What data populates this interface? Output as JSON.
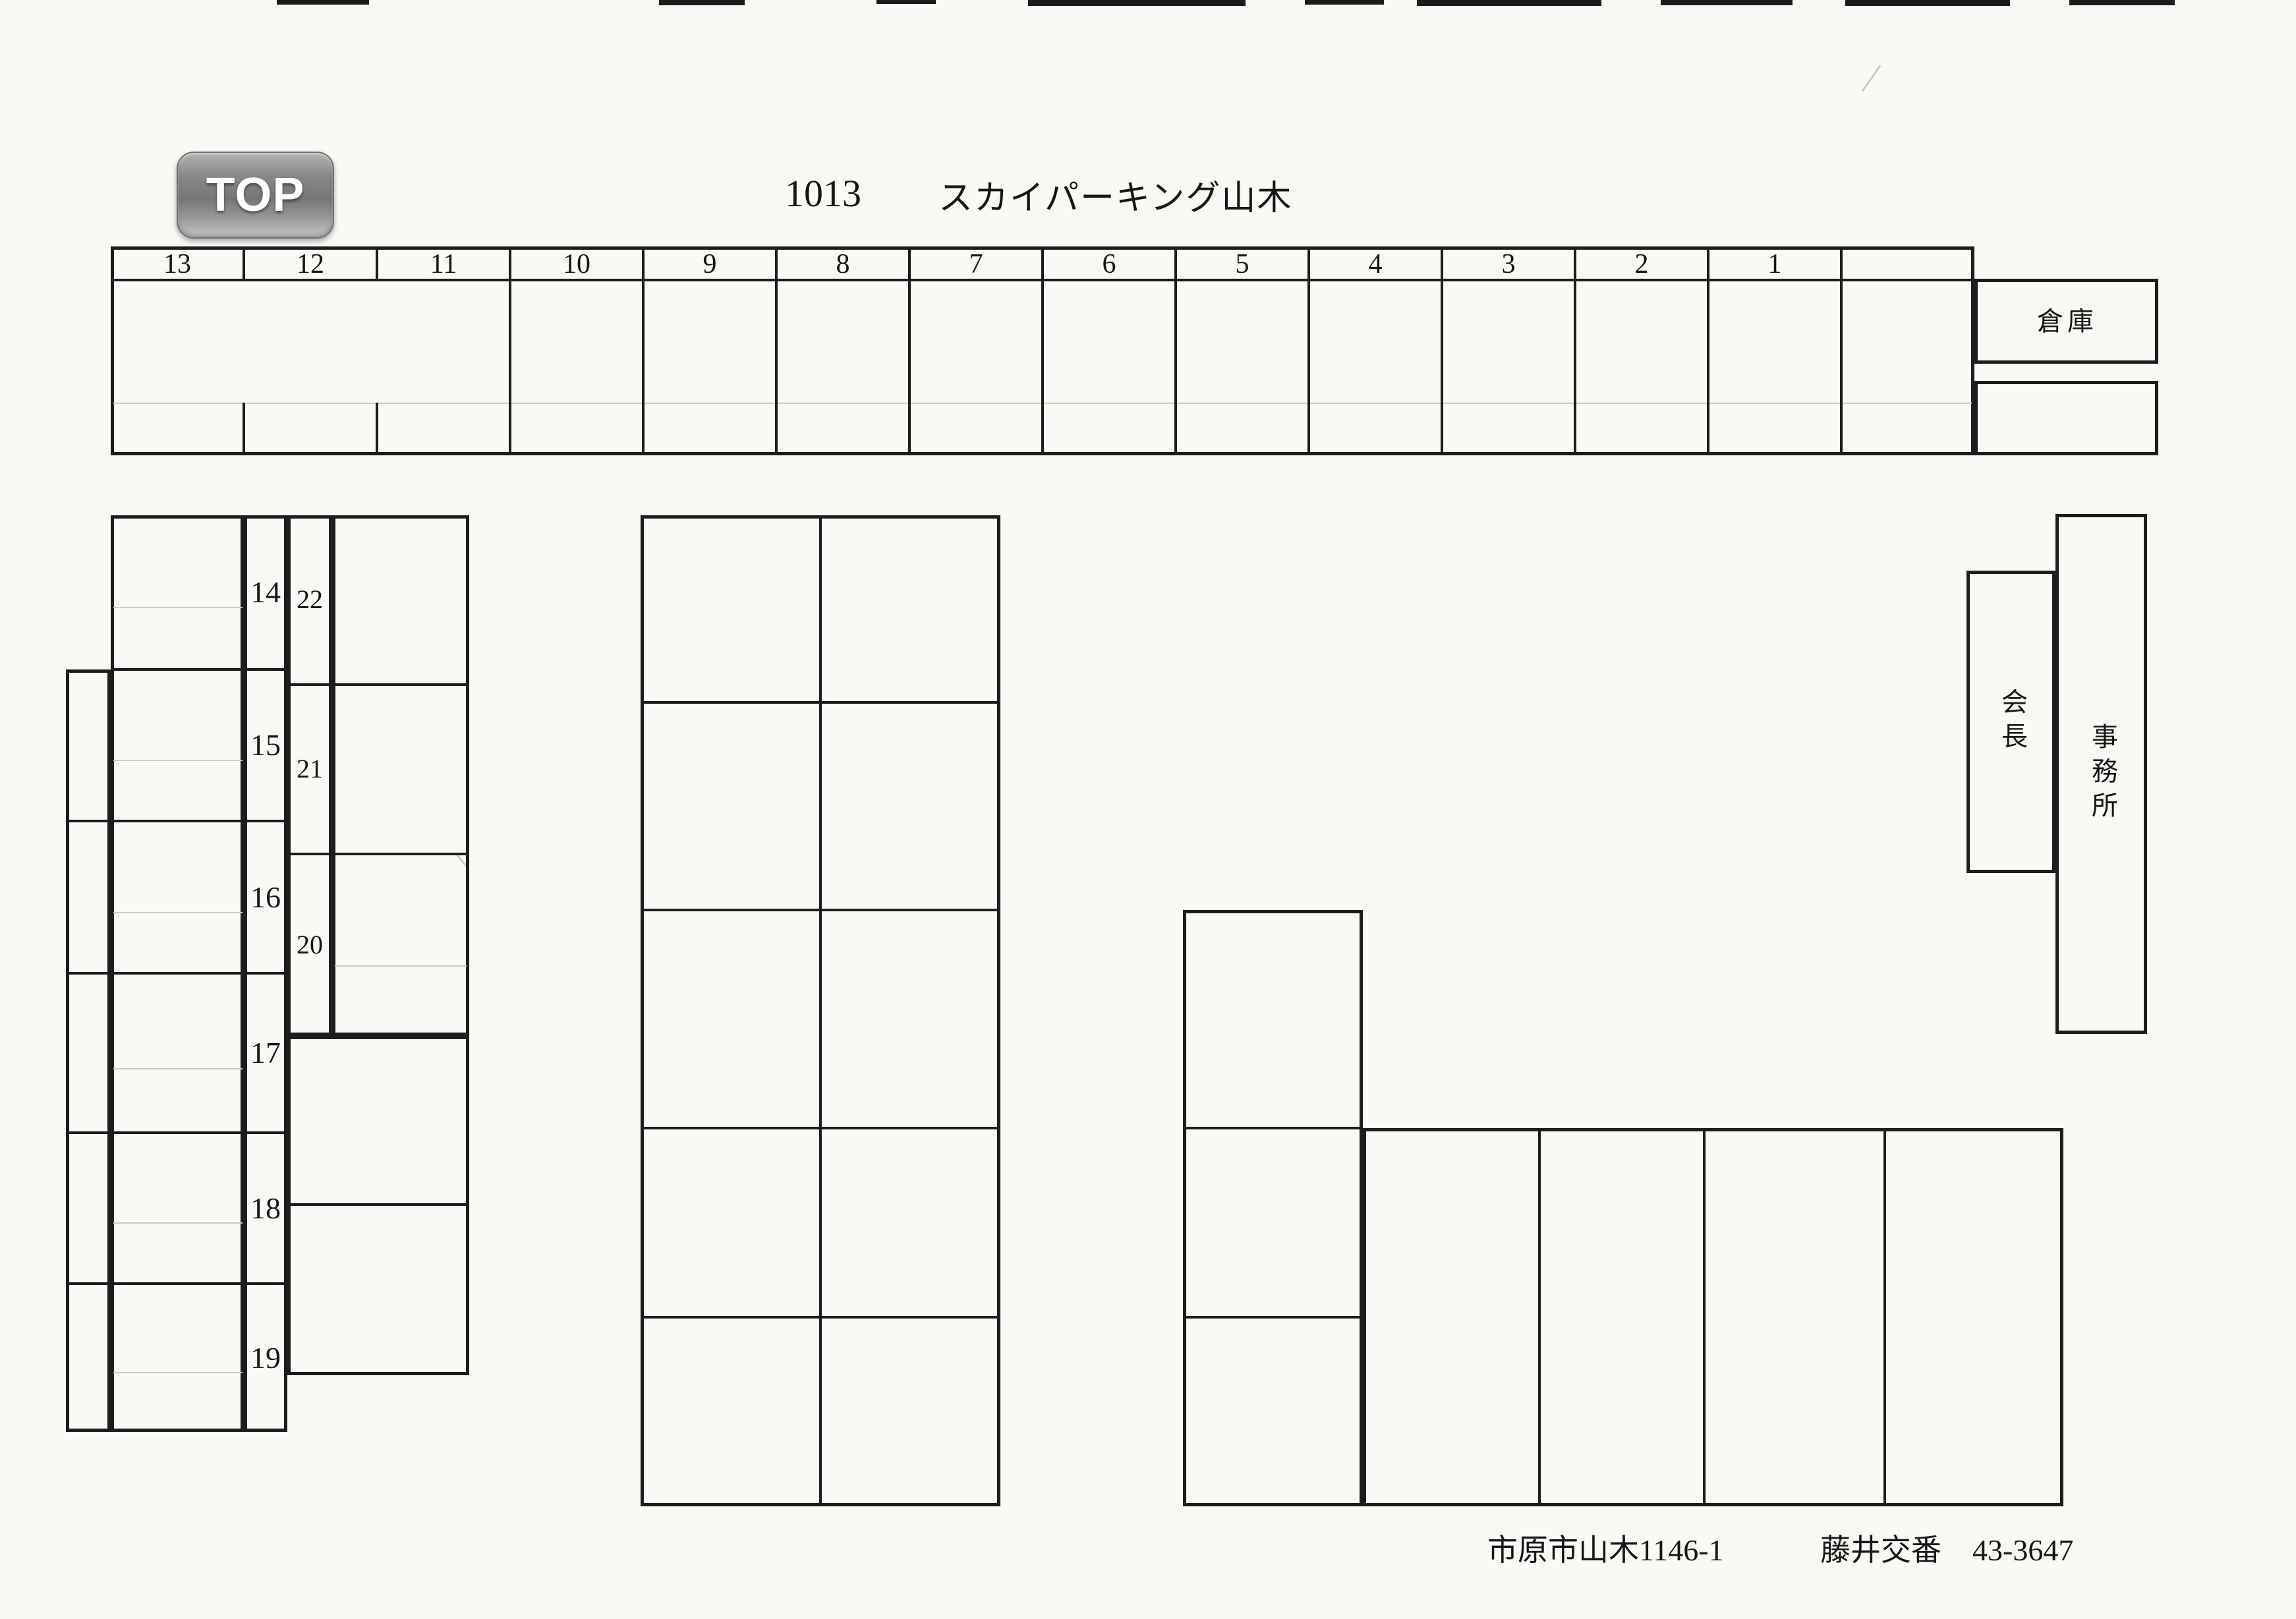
{
  "page": {
    "paper_color": "#f9f9f6",
    "line_color": "#1d1d1d",
    "faint_line_color": "#cbcbc7"
  },
  "top_button": {
    "label": "TOP",
    "body_color": "#8a8a8a",
    "text_color": "#ffffff"
  },
  "title": {
    "code": "1013",
    "name": "スカイパーキング山木"
  },
  "top_row": {
    "stall_labels": [
      "13",
      "12",
      "11",
      "10",
      "9",
      "8",
      "7",
      "6",
      "5",
      "4",
      "3",
      "2",
      "1"
    ]
  },
  "left_block": {
    "stall_labels": [
      "14",
      "15",
      "16",
      "17",
      "18",
      "19"
    ],
    "side_stall_labels": [
      "22",
      "21",
      "20"
    ]
  },
  "buildings": {
    "warehouse": "倉庫",
    "chairman": "会長",
    "office": "事務所"
  },
  "footer": {
    "address": "市原市山木1146-1",
    "police_box": "藤井交番",
    "phone": "43-3647"
  }
}
